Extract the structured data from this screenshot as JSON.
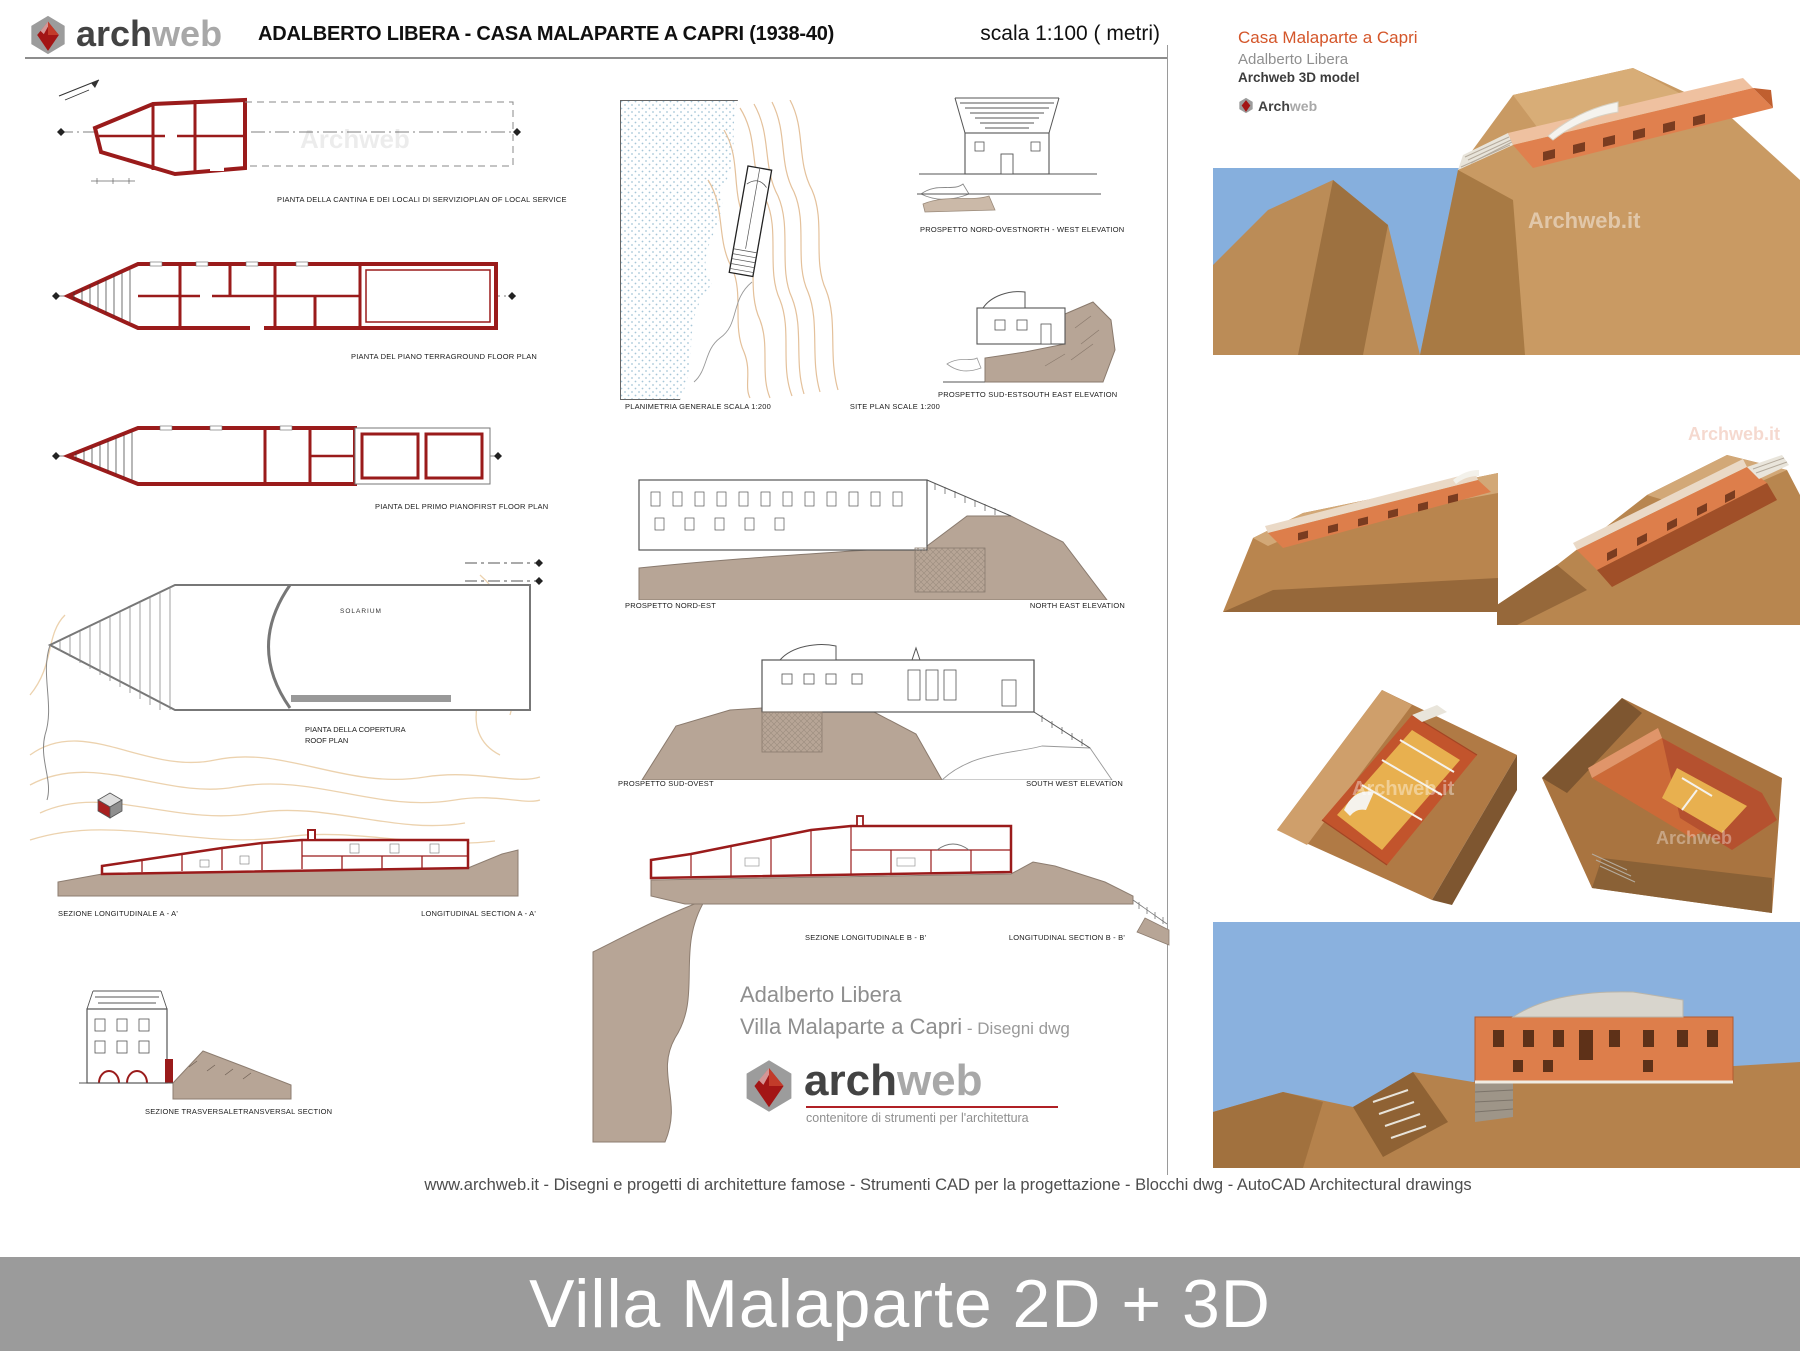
{
  "header": {
    "brand": {
      "arch": "arch",
      "web": "web"
    },
    "title": "ADALBERTO LIBERA - CASA  MALAPARTE A CAPRI (1938-40)",
    "scale_note": "scala 1:100 ( metri)"
  },
  "side_panel": {
    "title": "Casa Malaparte a  Capri",
    "architect": "Adalberto Libera",
    "model_note": "Archweb 3D model",
    "logo": {
      "arch": "Arch",
      "web": "web"
    }
  },
  "drawings": {
    "plan_cellar": {
      "it": "PIANTA DELLA CANTINA E DEI LOCALI DI SERVIZIO",
      "en": "PLAN OF LOCAL SERVICE"
    },
    "plan_ground": {
      "it": "PIANTA DEL PIANO TERRA",
      "en": "GROUND FLOOR PLAN"
    },
    "plan_first": {
      "it": "PIANTA DEL PRIMO PIANO",
      "en": "FIRST FLOOR PLAN"
    },
    "plan_roof": {
      "it": "PIANTA DELLA COPERTURA",
      "en": "ROOF PLAN",
      "room_label": "SOLARIUM"
    },
    "site_plan": {
      "it": "PLANIMETRIA GENERALE   SCALA 1:200",
      "en": "SITE PLAN  SCALE 1:200"
    },
    "elevation_nw": {
      "it": "PROSPETTO NORD-OVEST",
      "en": "NORTH - WEST ELEVATION"
    },
    "elevation_se": {
      "it": "PROSPETTO SUD-EST",
      "en": "SOUTH EAST ELEVATION"
    },
    "elevation_ne": {
      "it": "PROSPETTO NORD-EST",
      "en": "NORTH EAST ELEVATION"
    },
    "elevation_sw": {
      "it": "PROSPETTO SUD-OVEST",
      "en": "SOUTH WEST ELEVATION"
    },
    "section_a": {
      "it": "SEZIONE LONGITUDINALE  A - A'",
      "en": "LONGITUDINAL SECTION  A - A'"
    },
    "section_b": {
      "it": "SEZIONE LONGITUDINALE  B - B'",
      "en": "LONGITUDINAL SECTION  B - B'"
    },
    "section_t": {
      "it": "SEZIONE TRASVERSALE",
      "en": "TRANSVERSAL SECTION"
    }
  },
  "credit": {
    "architect": "Adalberto Libera",
    "project": "Villa Malaparte a Capri",
    "suffix": " - Disegni dwg",
    "logo": {
      "arch": "arch",
      "web": "web"
    },
    "tagline": "contenitore di strumenti per l'architettura"
  },
  "footer": {
    "text": "www.archweb.it -   Disegni e progetti di architetture famose  -  Strumenti CAD  per la progettazione  -  Blocchi dwg - AutoCAD Architectural drawings"
  },
  "banner": {
    "title": "Villa Malaparte 2D + 3D"
  },
  "watermark": {
    "short": "Archweb",
    "full": "Archweb.it"
  },
  "colors": {
    "wall_red": "#9a1b1b",
    "earth": "#b7a596",
    "contour": "#e8c49e",
    "sea_dots": "#a6c6d8",
    "sky": "#86afdd",
    "cliff": "#b5824c",
    "house": "#dd7e4b",
    "brand_orange": "#d4562a",
    "banner_bg": "#9b9b9b"
  }
}
